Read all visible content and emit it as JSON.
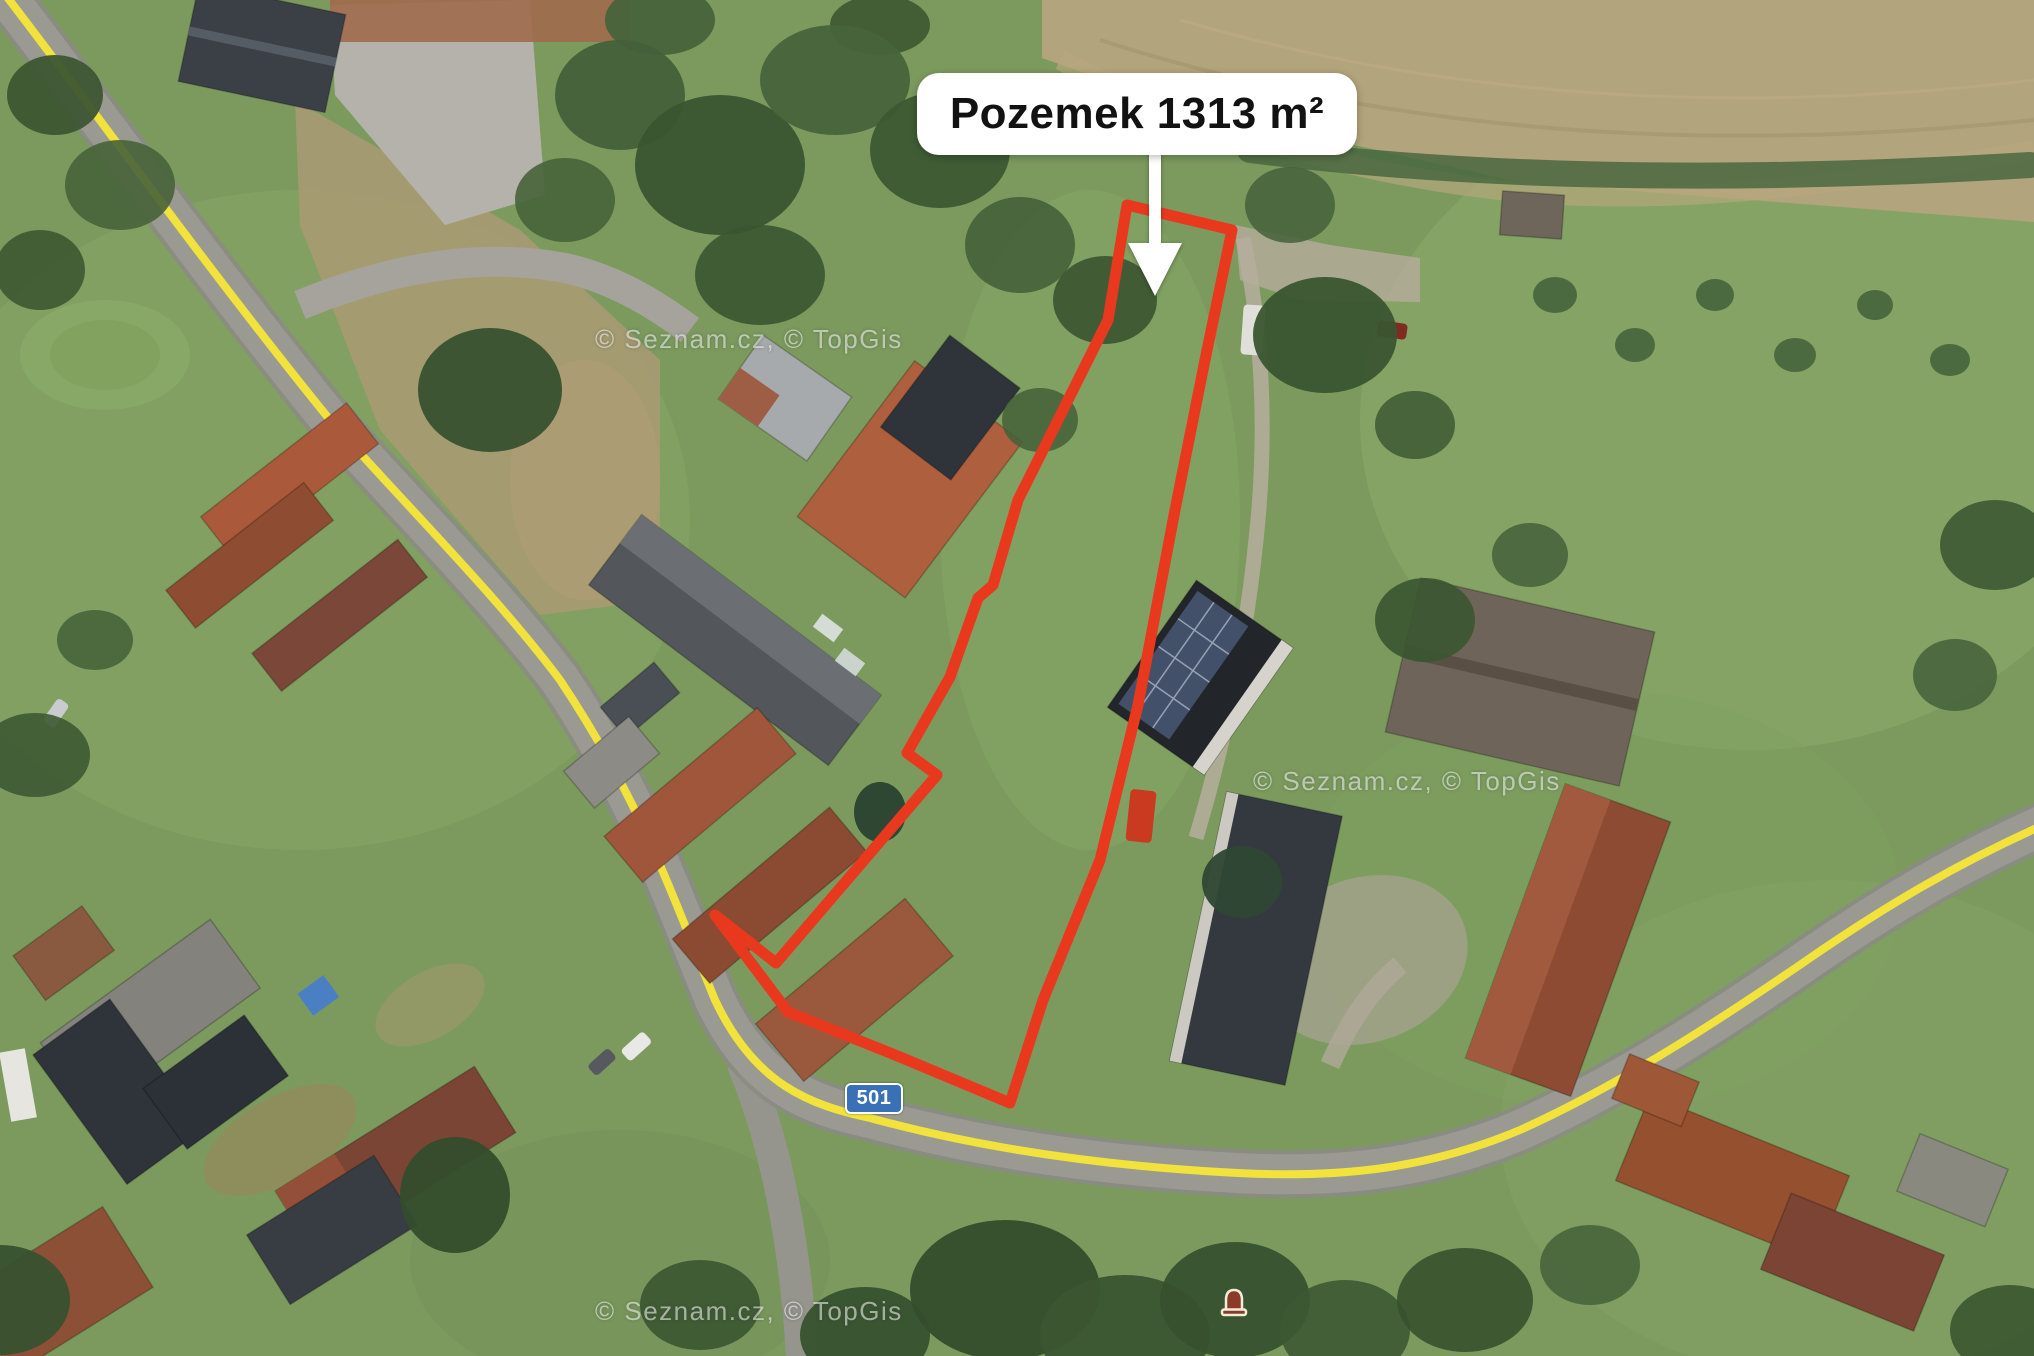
{
  "annotation": {
    "area_label": "Pozemek 1313 m²",
    "road_number": "501",
    "watermark": "© Seznam.cz, © TopGis"
  },
  "icons": {
    "callout_arrow": "down-arrow-icon",
    "poi_marker": "bell-marker-icon"
  },
  "theme": {
    "color-parcel": "#e8391f",
    "color-road-line": "#f2e23c",
    "color-badge": "#3a70b5",
    "color-label-bg": "#ffffff",
    "color-label-text": "#121212",
    "color-watermark": "rgba(255,255,255,0.55)"
  }
}
